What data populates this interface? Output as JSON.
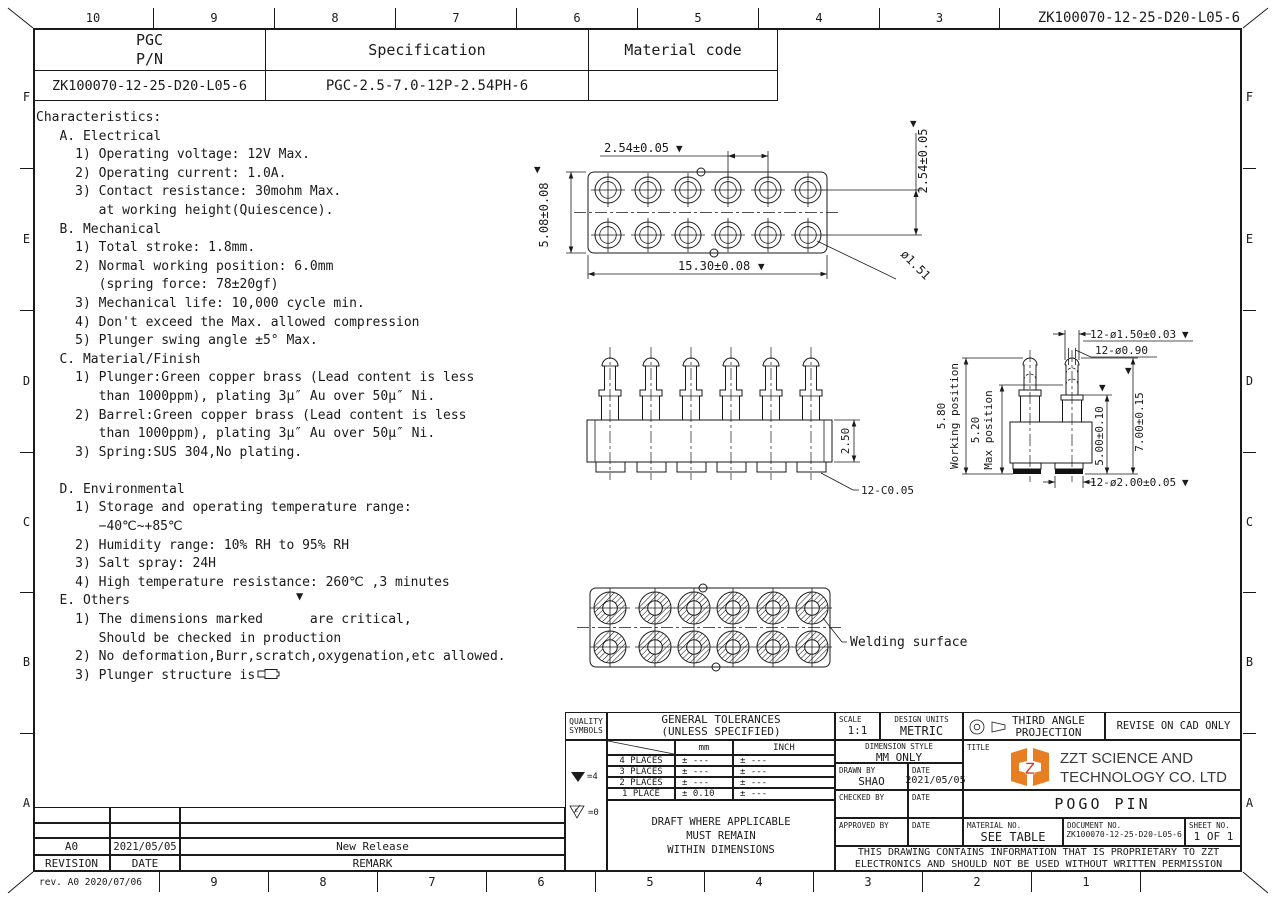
{
  "sheet": {
    "doc_number": "ZK100070-12-25-D20-L05-6",
    "rev_note": "rev. A0  2020/07/06",
    "top_cols": [
      "10",
      "9",
      "8",
      "7",
      "6",
      "5",
      "4",
      "3"
    ],
    "bottom_cols": [
      "9",
      "8",
      "7",
      "6",
      "5",
      "4",
      "3",
      "2",
      "1"
    ],
    "row_letters": [
      "F",
      "E",
      "D",
      "C",
      "B",
      "A"
    ]
  },
  "header_table": {
    "pn_label_1": "PGC",
    "pn_label_2": "P/N",
    "spec_label": "Specification",
    "material_label": "Material code",
    "pn_value": "ZK100070-12-25-D20-L05-6",
    "spec_value": "PGC-2.5-7.0-12P-2.54PH-6",
    "material_value": ""
  },
  "characteristics": {
    "lines": [
      "Characteristics:",
      "   A. Electrical",
      "     1) Operating voltage: 12V Max.",
      "     2) Operating current: 1.0A.",
      "     3) Contact resistance: 30mohm Max.",
      "        at working height(Quiescence).",
      "   B. Mechanical",
      "     1) Total stroke: 1.8mm.",
      "     2) Normal working position: 6.0mm",
      "        (spring force: 78±20gf)",
      "     3) Mechanical life: 10,000 cycle min.",
      "     4) Don't exceed the Max. allowed compression",
      "     5) Plunger swing angle ±5° Max.",
      "   C. Material/Finish",
      "     1) Plunger:Green copper brass (Lead content is less",
      "        than 1000ppm), plating 3μ″ Au over 50μ″ Ni.",
      "     2) Barrel:Green copper brass (Lead content is less",
      "        than 1000ppm), plating 3μ″ Au over 50μ″ Ni.",
      "     3) Spring:SUS 304,No plating.",
      "",
      "   D. Environmental",
      "     1) Storage and operating temperature range:",
      "        −40℃~+85℃",
      "     2) Humidity range: 10% RH to 95% RH",
      "     3) Salt spray: 24H",
      "     4) High temperature resistance: 260℃ ,3 minutes",
      "   E. Others",
      "     1) The dimensions marked      are critical,",
      "        Should be checked in production",
      "     2) No deformation,Burr,scratch,oxygenation,etc allowed.",
      "     3) Plunger structure is"
    ]
  },
  "marks": {
    "critical": "▼"
  },
  "drawings": {
    "top_view": {
      "pitch_h": "2.54±0.05",
      "pitch_v": "2.54±0.05",
      "row_pitch": "5.08±0.08",
      "length": "15.30±0.08",
      "hole_dia": "ø1.51"
    },
    "side_view": {
      "body_height": "2.50",
      "chamfer": "12-C0.05"
    },
    "end_view": {
      "plunger_dia": "12-ø1.50±0.03",
      "tip_dia": "12-ø0.90",
      "total_height": "7.00±0.15",
      "barrel_height": "5.00±0.10",
      "barrel_dia": "12-ø2.00±0.05",
      "working_height": "5.80",
      "working_label": "Working position",
      "max_height": "5.20",
      "max_label": "Max position"
    },
    "bottom_view": {
      "welding_label": "Welding surface"
    }
  },
  "quality": {
    "label_1": "QUALITY",
    "label_2": "SYMBOLS",
    "critical_eq": "=4",
    "c_eq": "=0",
    "c_letter": "c"
  },
  "tolerances": {
    "title_1": "GENERAL TOLERANCES",
    "title_2": "(UNLESS SPECIFIED)",
    "col_mm": "mm",
    "col_inch": "INCH",
    "rows": [
      {
        "label": "4 PLACES",
        "mm": "± ---",
        "inch": "± ---"
      },
      {
        "label": "3 PLACES",
        "mm": "± ---",
        "inch": "± ---"
      },
      {
        "label": "2 PLACES",
        "mm": "± ---",
        "inch": "± ---"
      },
      {
        "label": "1 PLACE",
        "mm": "± 0.10",
        "inch": "± ---"
      }
    ],
    "note_1": "DRAFT WHERE APPLICABLE",
    "note_2": "MUST REMAIN",
    "note_3": "WITHIN DIMENSIONS"
  },
  "titleblock": {
    "scale_label": "SCALE",
    "scale_value": "1:1",
    "units_label": "DESIGN UNITS",
    "units_value": "METRIC",
    "projection_line1": "THIRD ANGLE",
    "projection_line2": "PROJECTION",
    "revise_note": "REVISE ON CAD ONLY",
    "dim_style_label": "DIMENSION STYLE",
    "dim_style_value": "MM ONLY",
    "title_label": "TITLE",
    "company_line1": "ZZT SCIENCE AND",
    "company_line2": "TECHNOLOGY CO. LTD",
    "logo_letter": "Z",
    "drawn_label": "DRAWN BY",
    "drawn_value": "SHAO",
    "date_label": "DATE",
    "drawn_date": "2021/05/05",
    "checked_label": "CHECKED BY",
    "approved_label": "APPROVED BY",
    "part_title": "POGO PIN",
    "material_no_label": "MATERIAL NO.",
    "material_no_value": "SEE TABLE",
    "document_no_label": "DOCUMENT NO.",
    "document_no_value": "ZK100070-12-25-D20-L05-6",
    "sheet_no_label": "SHEET NO.",
    "sheet_no_value": "1 OF 1",
    "proprietary_line1": "THIS DRAWING CONTAINS INFORMATION THAT IS PROPRIETARY TO ZZT",
    "proprietary_line2": "ELECTRONICS AND SHOULD NOT BE USED WITHOUT WRITTEN PERMISSION"
  },
  "revisions": {
    "rows": [
      {
        "rev": "A0",
        "date": "2021/05/05",
        "remark": "New Release"
      }
    ],
    "footer_rev": "REVISION",
    "footer_date": "DATE",
    "footer_remark": "REMARK"
  },
  "colors": {
    "line": "#1a1a1a",
    "logo_orange": "#E87E22",
    "logo_red": "#D8321E"
  }
}
